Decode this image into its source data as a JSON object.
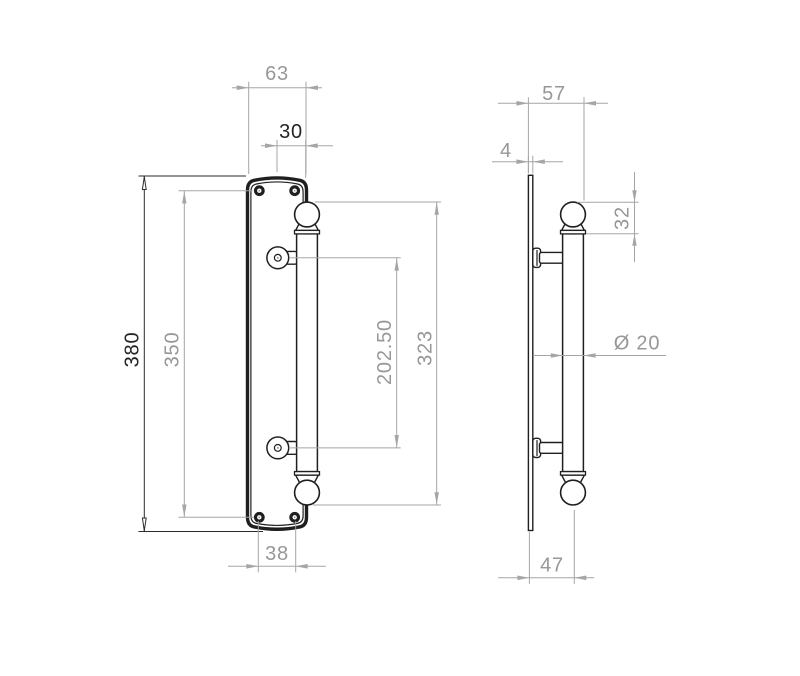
{
  "drawing": {
    "type": "technical-dimension-drawing",
    "subject": "door pull handle on backplate, front and side views",
    "units_shown": "none (numeric dimension labels only)",
    "colors": {
      "background": "#ffffff",
      "outline_black": "#1f1f1f",
      "dimension_gray": "#a5a5a5",
      "dimension_text_gray": "#979797",
      "dimension_black": "#2b2b2b"
    },
    "dims": {
      "front": {
        "plate_width": "63",
        "handle_offset": "30",
        "plate_height": "380",
        "fixing_height": "350",
        "lug_centres": "202.50",
        "handle_length": "323",
        "fixing_width": "38"
      },
      "side": {
        "overall_projection": "57",
        "plate_thickness": "4",
        "knob_height": "32",
        "grip_diameter": "Ø 20",
        "centre_projection": "47"
      }
    }
  }
}
